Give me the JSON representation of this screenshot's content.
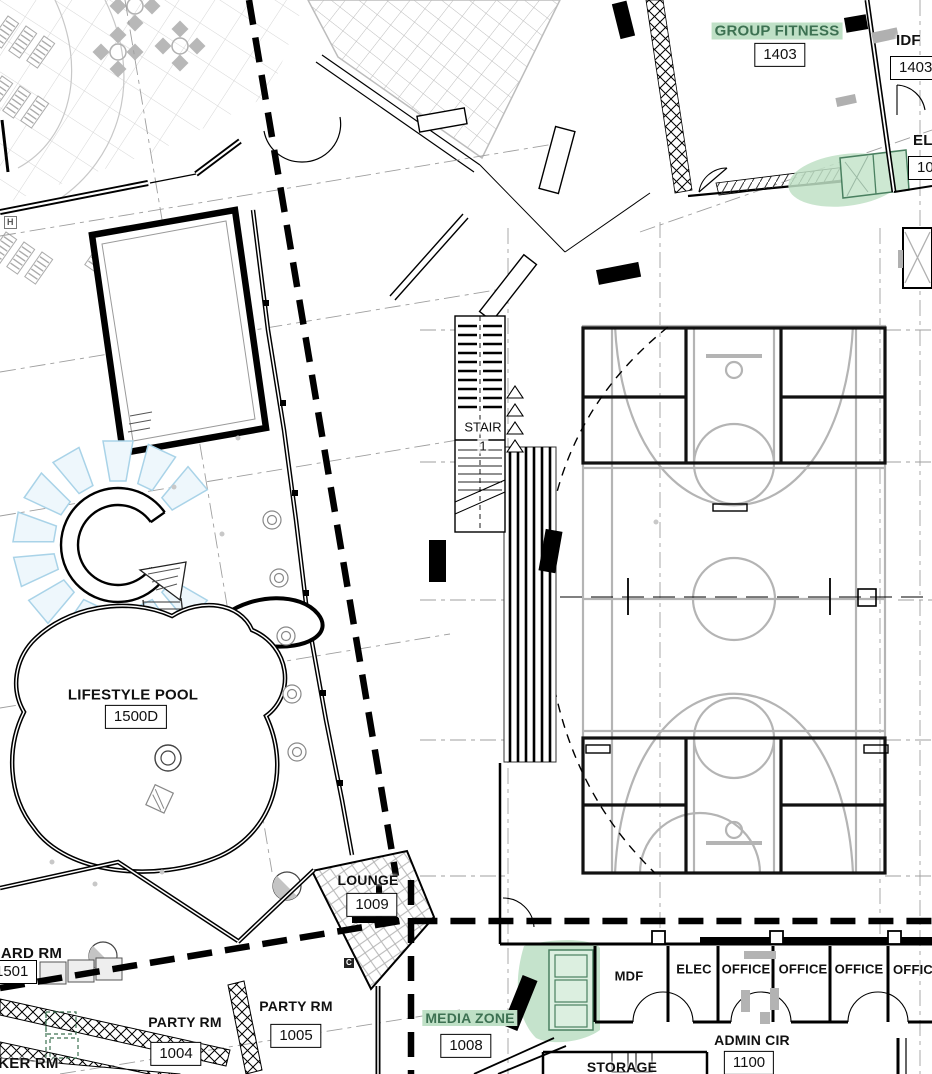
{
  "drawing": {
    "type": "architectural-floor-plan",
    "colors": {
      "highlight_green": "#bfe0c6",
      "label_green": "#3d7152",
      "court_gray": "#b4b4b4",
      "grid_gray": "#9f9f9f",
      "water_blue": "#a9d3e8"
    }
  },
  "labels": {
    "group_fitness": {
      "name": "GROUP FITNESS",
      "number": "1403"
    },
    "idf": {
      "name": "IDF",
      "number": "1403B"
    },
    "elev": {
      "name": "EL",
      "number": "10"
    },
    "stair1": {
      "name": "STAIR",
      "number": "1"
    },
    "lifestyle_pool": {
      "name": "LIFESTYLE POOL",
      "number": "1500D"
    },
    "lounge": {
      "name": "LOUNGE",
      "number": "1009"
    },
    "guard_rm": {
      "name": "GUARD RM",
      "number": "1501"
    },
    "locker_rm": {
      "name": "LOCKER RM"
    },
    "party_rm_a": {
      "name": "PARTY RM",
      "number": "1004"
    },
    "party_rm_b": {
      "name": "PARTY RM",
      "number": "1005"
    },
    "media_zone": {
      "name": "MEDIA ZONE",
      "number": "1008"
    },
    "mdf": {
      "name": "MDF"
    },
    "elec": {
      "name": "ELEC"
    },
    "office_1": {
      "name": "OFFICE"
    },
    "office_2": {
      "name": "OFFICE"
    },
    "office_3": {
      "name": "OFFICE"
    },
    "office_4": {
      "name": "OFFICE"
    },
    "admin_cir": {
      "name": "ADMIN CIR",
      "number": "1100"
    },
    "storage": {
      "name": "STORAGE"
    },
    "h_marker": "H",
    "c_keynote": "C"
  }
}
